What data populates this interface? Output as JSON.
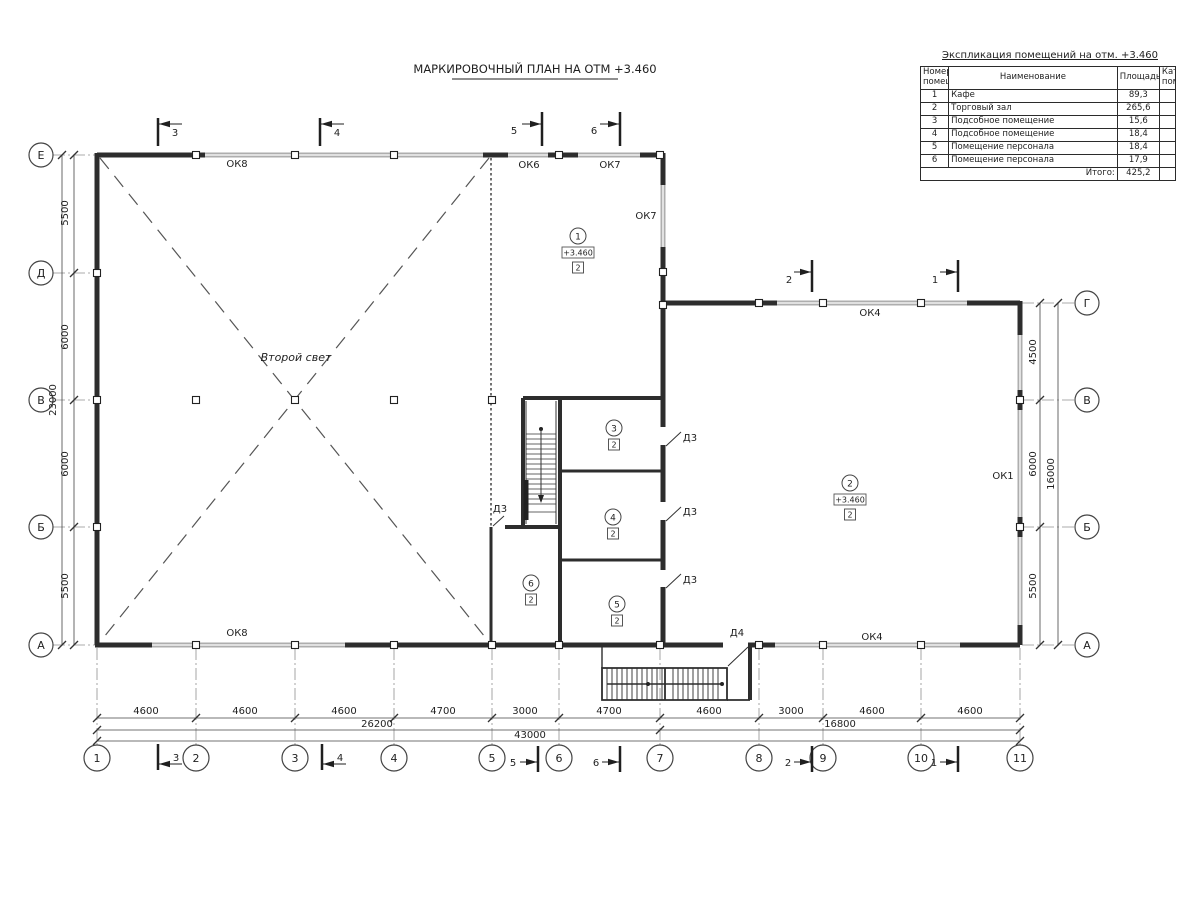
{
  "plan_title": "МАРКИРОВОЧНЫЙ ПЛАН НА ОТМ +3.460",
  "table": {
    "title": "Экспликация помещений на отм. +3.460",
    "headers": {
      "num": "Номер помещ.",
      "name": "Наименование",
      "area": "Площадь",
      "cat": "Кат. пом."
    },
    "rows": [
      {
        "num": "1",
        "name": "Кафе",
        "area": "89,3",
        "cat": ""
      },
      {
        "num": "2",
        "name": "Торговый зал",
        "area": "265,6",
        "cat": ""
      },
      {
        "num": "3",
        "name": "Подсобное помещение",
        "area": "15,6",
        "cat": ""
      },
      {
        "num": "4",
        "name": "Подсобное помещение",
        "area": "18,4",
        "cat": ""
      },
      {
        "num": "5",
        "name": "Помещение персонала",
        "area": "18,4",
        "cat": ""
      },
      {
        "num": "6",
        "name": "Помещение персонала",
        "area": "17,9",
        "cat": ""
      }
    ],
    "total_label": "Итого:",
    "total_value": "425,2"
  },
  "grid": {
    "cols": [
      "1",
      "2",
      "3",
      "4",
      "5",
      "6",
      "7",
      "8",
      "9",
      "10",
      "11"
    ],
    "rows_left": [
      "Е",
      "Д",
      "В",
      "Б",
      "А"
    ],
    "rows_right": [
      "Г",
      "В",
      "Б",
      "А"
    ]
  },
  "dims": {
    "bottom": [
      "4600",
      "4600",
      "4600",
      "4700",
      "3000",
      "4700",
      "4600",
      "3000",
      "4600",
      "4600"
    ],
    "bottom_sub": [
      "26200",
      "16800"
    ],
    "bottom_total": "43000",
    "left": [
      "5500",
      "6000",
      "6000",
      "5500"
    ],
    "left_total": "23000",
    "right": [
      "4500",
      "6000",
      "5500"
    ],
    "right_total": "16000"
  },
  "sections": {
    "s1": "1",
    "s2": "2",
    "s3": "3",
    "s4": "4",
    "s5": "5",
    "s6": "6"
  },
  "windows": {
    "ok1": "ОК1",
    "ok4": "ОК4",
    "ok6": "ОК6",
    "ok7": "ОК7",
    "ok8": "ОК8"
  },
  "doors": {
    "d3": "Д3",
    "d4": "Д4"
  },
  "rooms": {
    "r1": {
      "num": "1",
      "elev": "+3.460",
      "mark": "2"
    },
    "r2": {
      "num": "2",
      "elev": "+3.460",
      "mark": "2"
    },
    "r3": {
      "num": "3",
      "mark": "2"
    },
    "r4": {
      "num": "4",
      "mark": "2"
    },
    "r5": {
      "num": "5",
      "mark": "2"
    },
    "r6": {
      "num": "6",
      "mark": "2"
    }
  },
  "annotations": {
    "second_light": "Второй свет"
  }
}
